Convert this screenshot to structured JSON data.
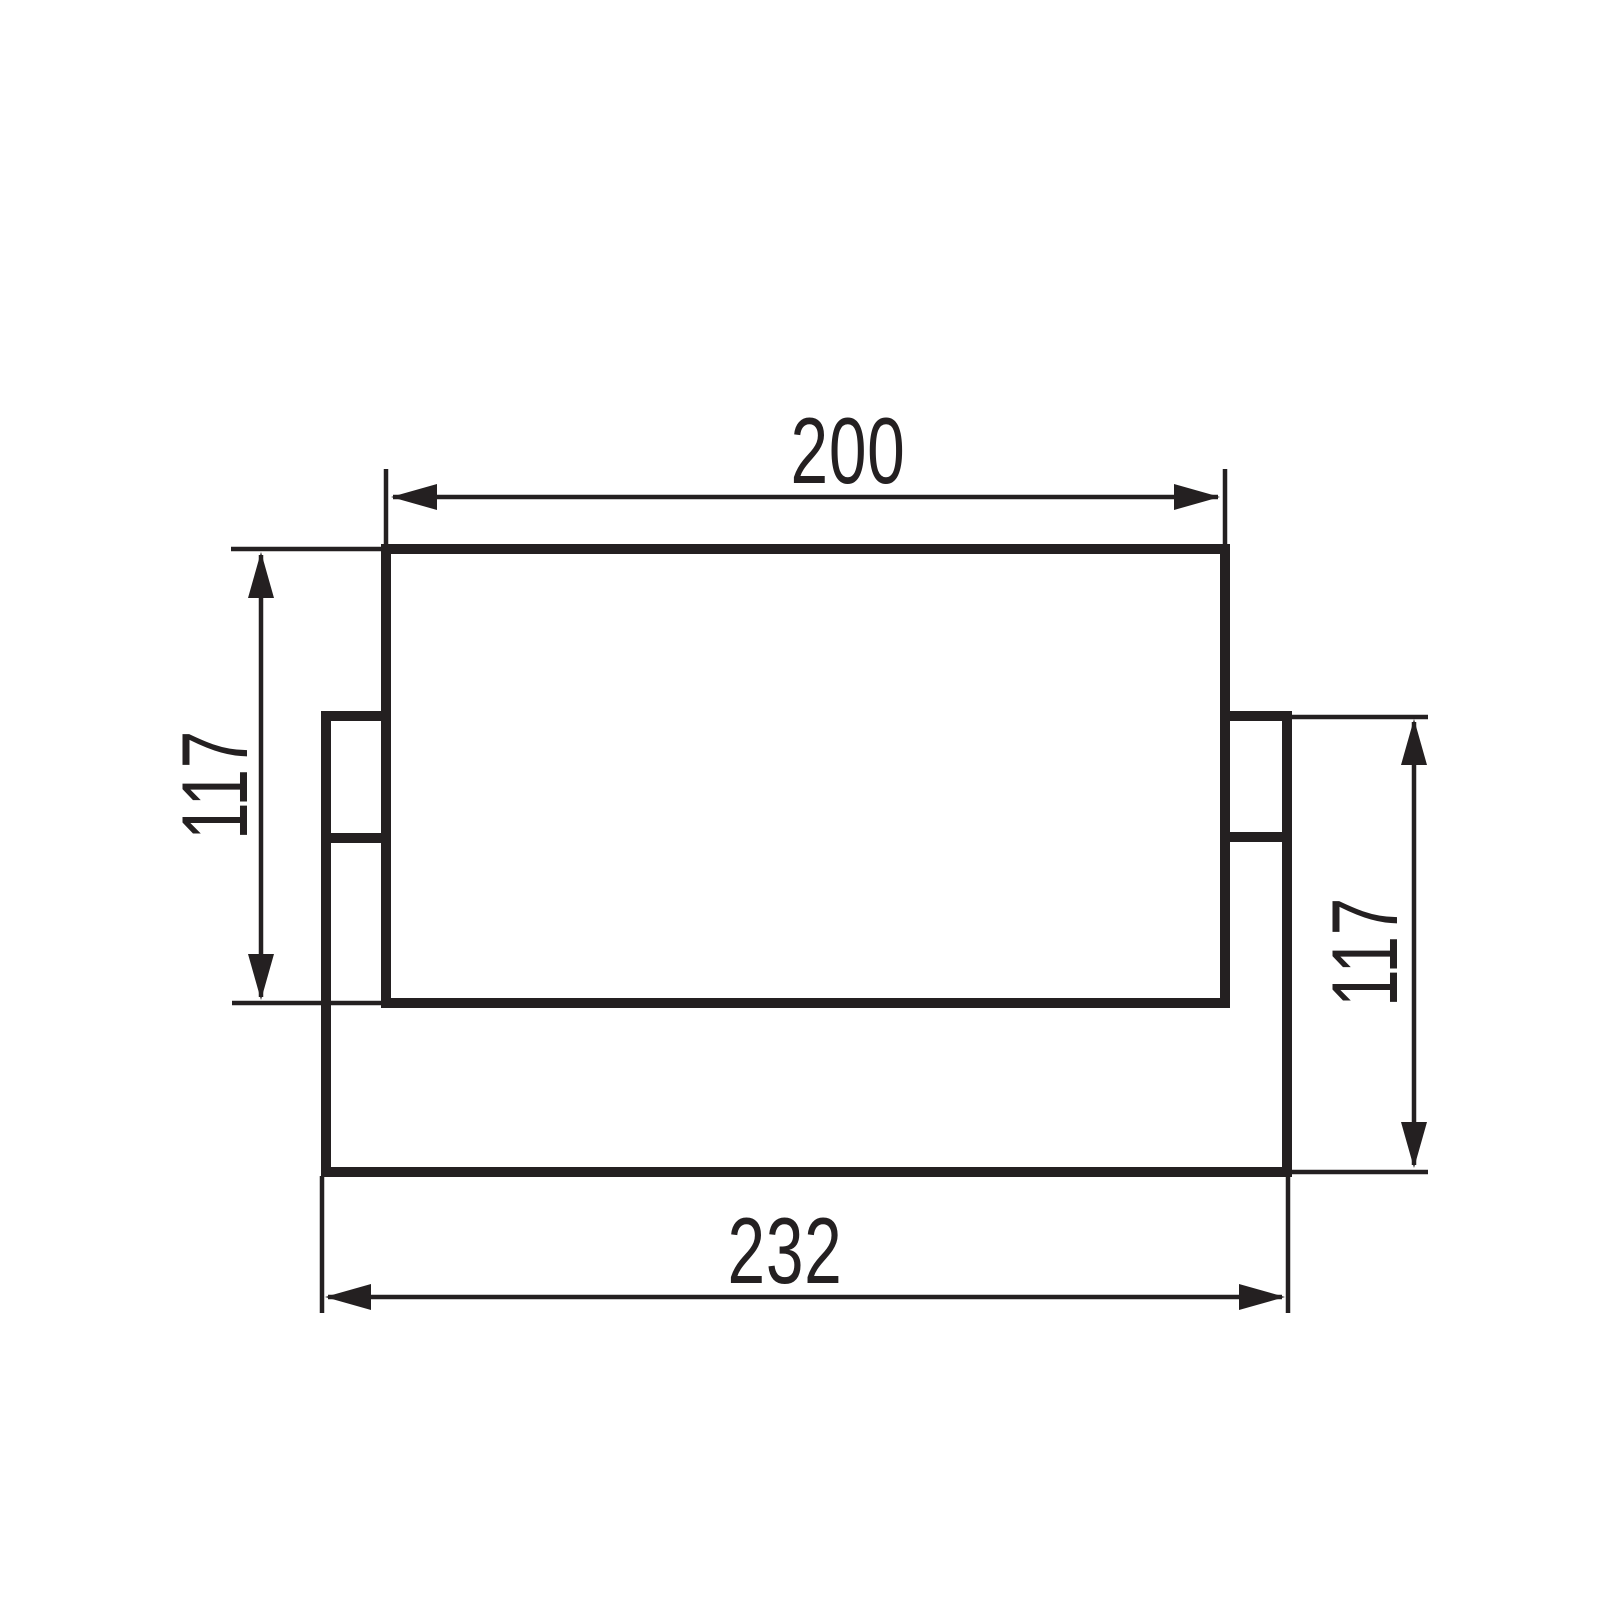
{
  "drawing": {
    "type": "technical-dimension-drawing",
    "dimensions": {
      "top_width": "200",
      "left_height": "117",
      "right_height": "117",
      "bottom_width": "232"
    },
    "watermark": "lampemania.dk",
    "colors": {
      "line": "#242021",
      "watermark": "#e8e8e8",
      "background": "#ffffff"
    }
  }
}
